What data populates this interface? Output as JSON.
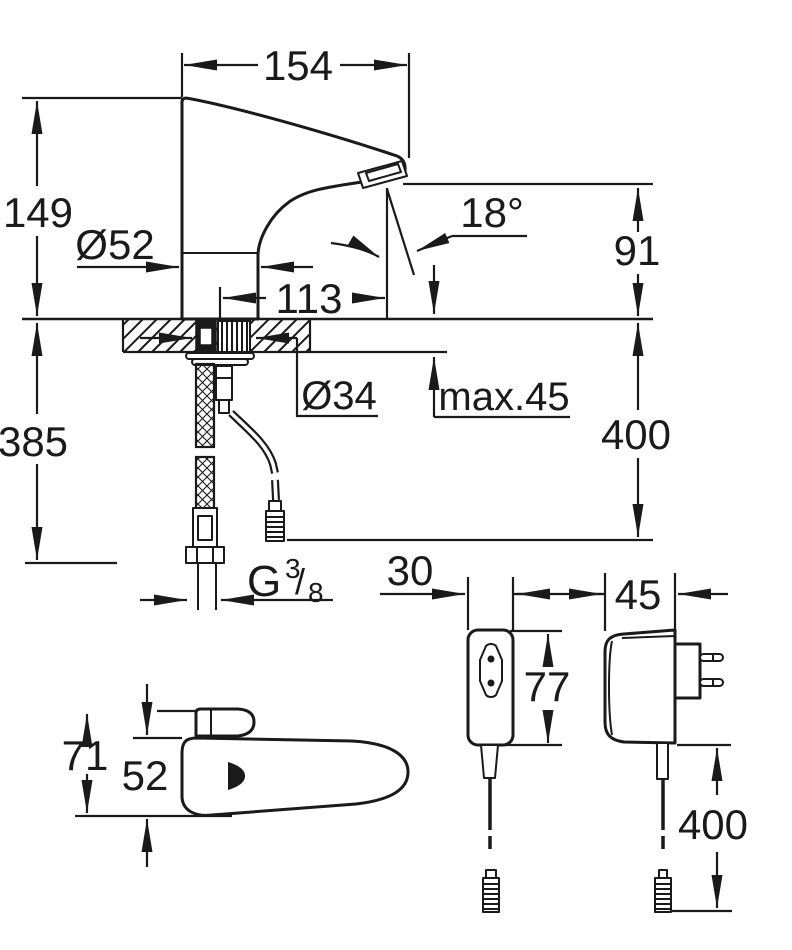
{
  "title": "Faucet technical dimension drawing",
  "colors": {
    "line": "#1a1a1a",
    "background": "#ffffff"
  },
  "views": {
    "side": {
      "spout_length": "154",
      "body_height": "149",
      "base_diameter": "Ø52",
      "spout_reach": "113",
      "spray_angle": "18°",
      "outlet_height": "91",
      "hole_diameter": "Ø34",
      "deck_max_thickness": "max.45",
      "cable_length": "400",
      "hose_length": "385",
      "thread_prefix": "G",
      "thread_numerator": "3",
      "thread_slash": "/",
      "thread_denominator": "8"
    },
    "top": {
      "overall_depth": "71",
      "body_width": "52"
    },
    "socket": {
      "width": "30",
      "height": "77"
    },
    "adapter": {
      "width": "45",
      "cable_length": "400"
    }
  }
}
